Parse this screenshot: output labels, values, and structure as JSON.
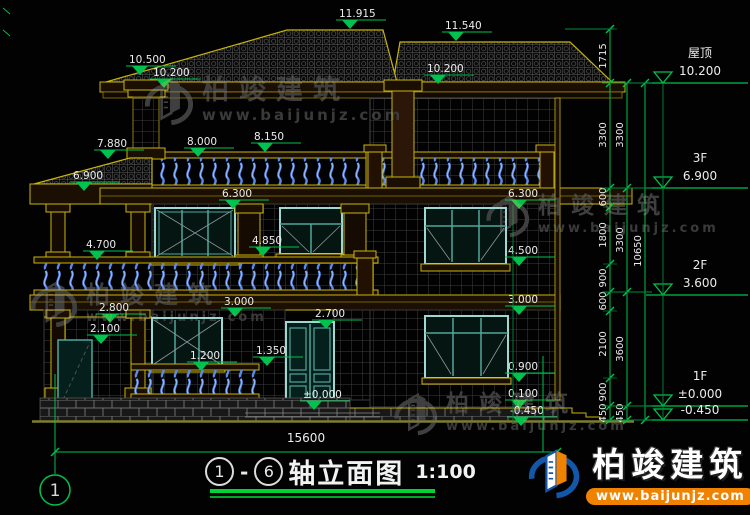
{
  "title": {
    "axis_start": "1",
    "axis_end": "6",
    "dash": "-",
    "name": "轴立面图",
    "scale": "1:100"
  },
  "axis_bubble": "1",
  "ground_dimension": "15600",
  "watermark": {
    "brand": "柏竣建筑",
    "site": "www.baijunjz.com"
  },
  "logo": {
    "brand": "柏竣建筑",
    "site": "www.baijunjz.com"
  },
  "colors": {
    "dim_green": "#00c24e",
    "dim_green_dark": "#008a3a",
    "trim_yellow": "#c9b50b",
    "trim_dark": "#8f7e08",
    "teal": "#4fa79b",
    "teal_bright": "#9fd8d0",
    "baluster_blue": "#5b8ae8",
    "ground_olive": "#7d7d2e",
    "text_white": "#ececec",
    "watermark_gray": "#3f3f3f",
    "logo_blue": "#1257a8",
    "logo_orange": "#f08200"
  },
  "level_markers": [
    {
      "value": "11.915",
      "x": 336,
      "y": 20
    },
    {
      "value": "11.540",
      "x": 442,
      "y": 32
    },
    {
      "value": "10.500",
      "x": 126,
      "y": 66
    },
    {
      "value": "10.200",
      "x": 150,
      "y": 79
    },
    {
      "value": "10.200",
      "x": 424,
      "y": 75
    },
    {
      "value": "7.880",
      "x": 94,
      "y": 150
    },
    {
      "value": "8.000",
      "x": 184,
      "y": 148
    },
    {
      "value": "8.150",
      "x": 251,
      "y": 143
    },
    {
      "value": "6.900",
      "x": 70,
      "y": 182
    },
    {
      "value": "6.300",
      "x": 219,
      "y": 200
    },
    {
      "value": "6.300",
      "x": 505,
      "y": 200
    },
    {
      "value": "4.700",
      "x": 83,
      "y": 251
    },
    {
      "value": "4.850",
      "x": 249,
      "y": 247
    },
    {
      "value": "4.500",
      "x": 505,
      "y": 257
    },
    {
      "value": "2.800",
      "x": 96,
      "y": 314
    },
    {
      "value": "3.000",
      "x": 221,
      "y": 308
    },
    {
      "value": "2.700",
      "x": 312,
      "y": 320
    },
    {
      "value": "3.000",
      "x": 505,
      "y": 306
    },
    {
      "value": "2.100",
      "x": 87,
      "y": 335
    },
    {
      "value": "1.200",
      "x": 187,
      "y": 362
    },
    {
      "value": "1.350",
      "x": 253,
      "y": 357
    },
    {
      "value": "0.900",
      "x": 505,
      "y": 373
    },
    {
      "value": "±0.000",
      "x": 300,
      "y": 401
    },
    {
      "value": "0.100",
      "x": 505,
      "y": 400
    },
    {
      "value": "-0.450",
      "x": 507,
      "y": 417
    }
  ],
  "floor_levels": [
    {
      "label": "屋顶",
      "value": "10.200",
      "y": 83
    },
    {
      "label": "3F",
      "value": "6.900",
      "y": 188
    },
    {
      "label": "2F",
      "value": "3.600",
      "y": 295
    },
    {
      "label": "1F",
      "value": "±0.000",
      "y": 406
    },
    {
      "label": "",
      "value": "-0.450",
      "y": 420
    }
  ],
  "dim_chains": [
    {
      "x": 610,
      "ticks": [
        29,
        83,
        188,
        207,
        264,
        292,
        311,
        378,
        406,
        420
      ],
      "labels": [
        {
          "t": "1715",
          "y": 56
        },
        {
          "t": "3300",
          "y": 135
        },
        {
          "t": "600",
          "y": 197
        },
        {
          "t": "1800",
          "y": 235
        },
        {
          "t": "900",
          "y": 278
        },
        {
          "t": "600",
          "y": 301
        },
        {
          "t": "2100",
          "y": 344
        },
        {
          "t": "900",
          "y": 392
        },
        {
          "t": "450",
          "y": 413
        }
      ]
    },
    {
      "x": 627,
      "ticks": [
        83,
        188,
        292,
        406,
        420
      ],
      "labels": [
        {
          "t": "3300",
          "y": 135
        },
        {
          "t": "3300",
          "y": 240
        },
        {
          "t": "3600",
          "y": 349
        },
        {
          "t": "450",
          "y": 413
        }
      ]
    },
    {
      "x": 645,
      "ticks": [
        83,
        420
      ],
      "labels": [
        {
          "t": "10650",
          "y": 251
        }
      ]
    }
  ],
  "watermark_instances": [
    {
      "x": 140,
      "y": 70,
      "icon": 54,
      "brand_size": 27,
      "site_size": 15
    },
    {
      "x": 482,
      "y": 188,
      "icon": 48,
      "brand_size": 23,
      "site_size": 13
    },
    {
      "x": 26,
      "y": 274,
      "icon": 52,
      "brand_size": 24,
      "site_size": 13
    },
    {
      "x": 390,
      "y": 386,
      "icon": 48,
      "brand_size": 23,
      "site_size": 13
    }
  ]
}
